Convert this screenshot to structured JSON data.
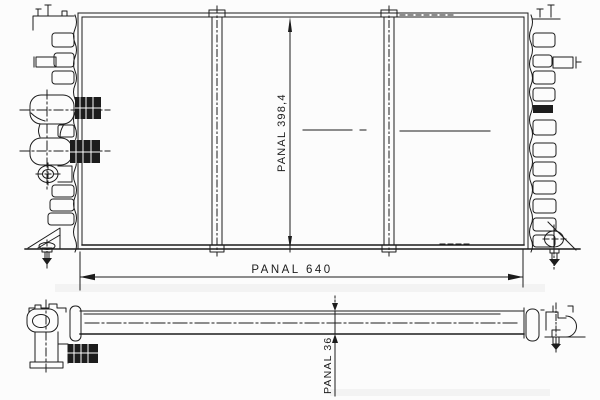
{
  "drawing": {
    "dimensions": {
      "width": {
        "label": "PANAL",
        "value": "640",
        "text": "PANAL  640"
      },
      "height": {
        "label": "PANAL",
        "value": "398,4",
        "text": "PANAL  398,4"
      },
      "depth": {
        "label": "PANAL",
        "value": "36",
        "text": "PANAL  36"
      }
    },
    "colors": {
      "line": "#1c1c1c",
      "background": "#fcfcfc",
      "scan_artifact": "#ebebeb"
    }
  }
}
